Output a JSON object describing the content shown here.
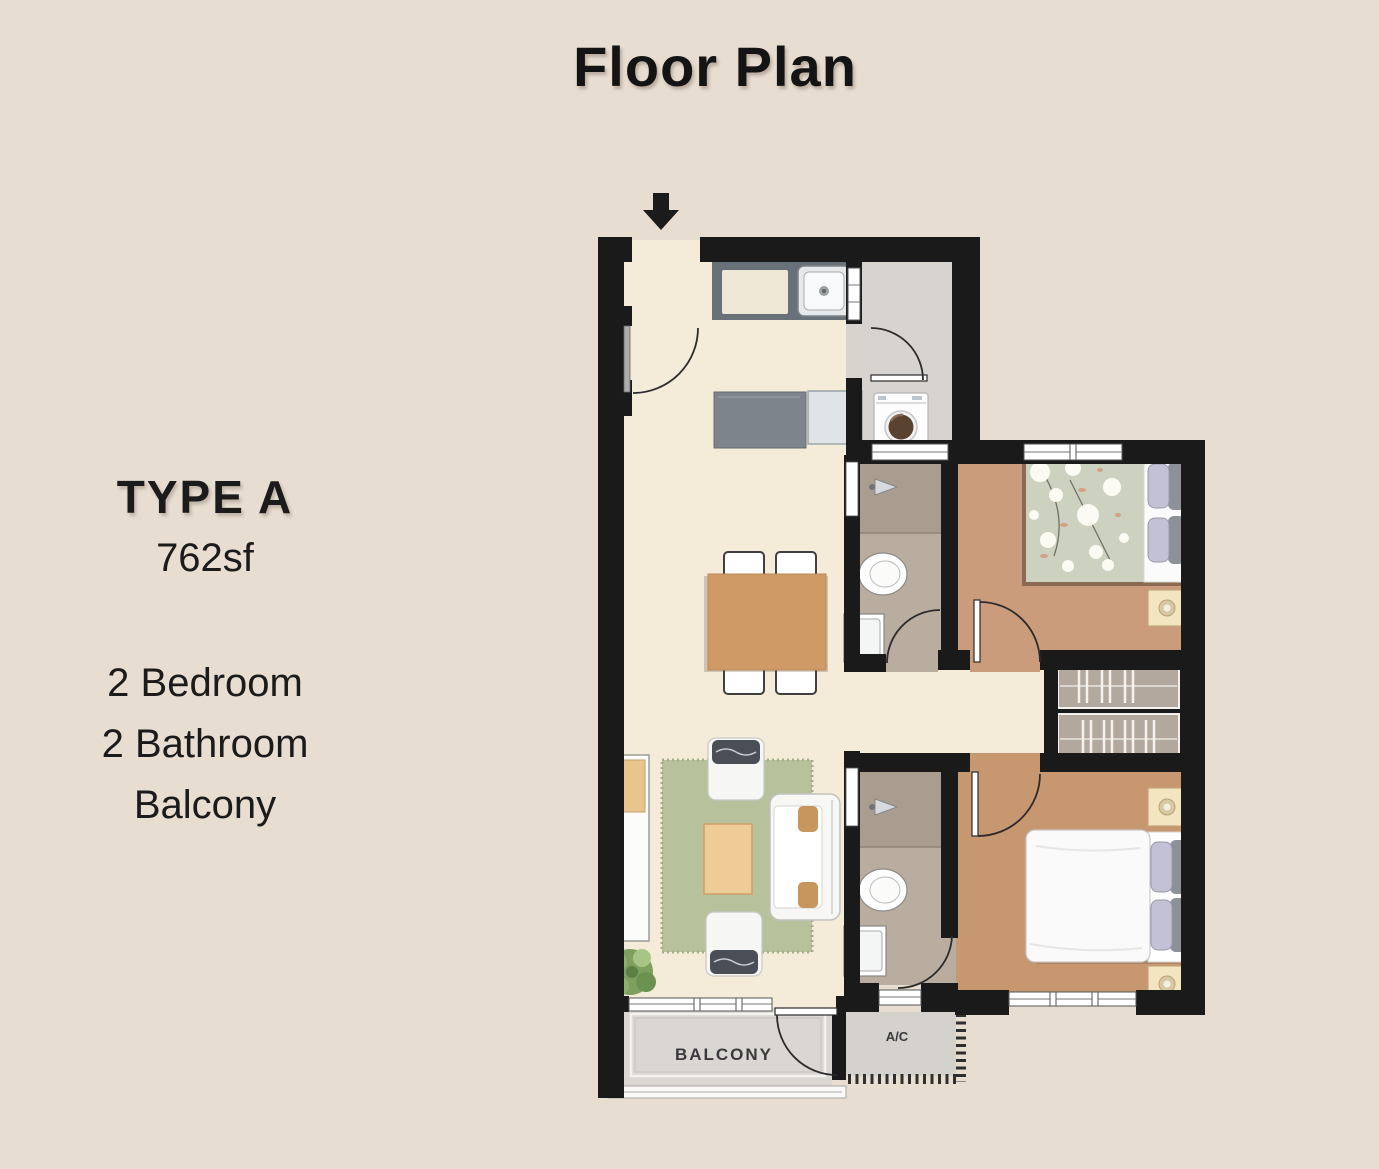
{
  "header": {
    "title": "Floor Plan"
  },
  "unit": {
    "type_label": "TYPE A",
    "area": "762sf",
    "features": [
      "2 Bedroom",
      "2 Bathroom",
      "Balcony"
    ]
  },
  "plan": {
    "labels": {
      "balcony": "BALCONY",
      "ac": "A/C"
    },
    "rooms": [
      "Entry",
      "Kitchen",
      "Yard",
      "Dining",
      "Living",
      "Bathroom 1",
      "Bathroom 2",
      "Bedroom 2",
      "Master Bedroom",
      "Wardrobes",
      "Balcony",
      "A/C Ledge"
    ],
    "entrance_marker": "down-arrow"
  },
  "palette": {
    "page_background": "#e7ddd0",
    "wall": "#1a1a1a",
    "floor_living": "#f4ecd9",
    "floor_bedroom": "#cb9c7c",
    "floor_master": "#c79770",
    "floor_bathroom": "#b8ad9e",
    "floor_shower": "#a89d8e",
    "floor_yard": "#d7d4cf",
    "floor_balcony": "#dad7d2",
    "rug": "#b7c19c",
    "table_wood": "#d09a66",
    "coffee_table": "#efcb96",
    "kitchen_counter": "#687078",
    "text": "#1b1b1b"
  }
}
